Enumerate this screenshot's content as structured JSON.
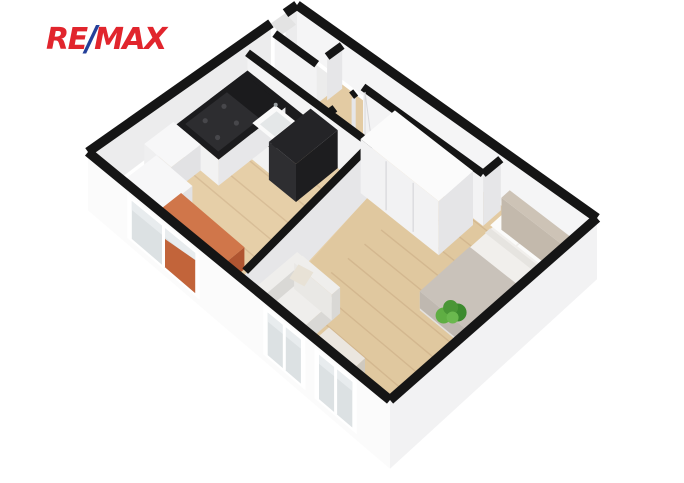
{
  "logo": {
    "re": "RE",
    "slash": "/",
    "max": "MAX",
    "red": "#E1252D",
    "blue": "#24409A"
  },
  "scene": {
    "background": "#ffffff",
    "description": "3D isometric cutaway floor plan of a one-bedroom apartment",
    "rooms": [
      "entry-vestibule",
      "bathroom",
      "hallway",
      "kitchen",
      "living-bedroom"
    ],
    "objects": [
      "kitchen-counter",
      "cooktop",
      "kitchen-sink",
      "tall-black-cabinet",
      "white-cabinet",
      "washing-machine",
      "orange-dining-table",
      "wardrobe",
      "double-bed",
      "pillows",
      "headboard",
      "sofa",
      "sofa-pillow",
      "coffee-table",
      "plant",
      "window",
      "window",
      "window",
      "entry-door-opening",
      "bathroom-door-opening",
      "bedroom-door"
    ],
    "palette": {
      "wall_top": "#151515",
      "wall_face_u": "#f3f3f4",
      "wall_face_v": "#e6e6e8",
      "ext_tl_face": "#ececed",
      "ext_tr_face": "#f5f5f6",
      "ext_out_bl": "#fbfbfb",
      "ext_out_br": "#f2f2f3",
      "inner_bl": "#dcdcdd",
      "inner_br": "#e9e9eb",
      "floor_white": "#ececec",
      "floor_hall": "#e3cba3",
      "floor_kitchen": "#e6cfa8",
      "floor_bedroom": "#e0c89f",
      "plank_line": "rgba(140,100,60,0.16)",
      "counter_top": "#1b1b1d",
      "counter_face": "#f2f2f2",
      "counter_side": "#e7e7e9",
      "cooktop": "#2d2d30",
      "burner": "#47474b",
      "sink": "#fafafa",
      "sink_inner": "#e4e7e8",
      "faucet": "#9aa0a3",
      "tower_top": "#242427",
      "tower_l": "#2e2e31",
      "tower_r": "#1d1d1f",
      "appliance_top": "#f7f7f8",
      "appliance_l": "#efeff0",
      "appliance_r": "#e2e2e4",
      "washer_door": "#d4d4d7",
      "washer_door_in": "#bcbcc0",
      "orange_top": "#d0764a",
      "orange_l": "#c2643a",
      "orange_r": "#b05531",
      "wardrobe_top": "#fbfbfb",
      "wardrobe_front": "#f2f2f3",
      "wardrobe_side": "#e5e5e7",
      "wardrobe_seam": "#dcdcdf",
      "headboard_top": "#cdc3b6",
      "headboard_l": "#c3b9ac",
      "headboard_r": "#b7ad a0",
      "mattress_top": "#f1efec",
      "mattress_l": "#e4e1dd",
      "mattress_r": "#d8d5d0",
      "blanket": "#c9c2ba",
      "blanket_drape": "#bfb8b0",
      "pillow": "#fbfbfa",
      "pillow_edge": "#e6e4e0",
      "sofa_top": "#efeeec",
      "sofa_l": "#e9e8e5",
      "sofa_r": "#d9d8d5",
      "sofa_pillow": "#e8e2d6",
      "ctable_top": "#ebe6df",
      "ctable_l": "#ded8ce",
      "ctable_r": "#cfc9bf",
      "plant_1": "#4a9636",
      "plant_2": "#5fae43",
      "plant_3": "#3c8a2e",
      "plant_4": "#6ab84e",
      "glass": "#dce1e3",
      "glass_hi": "#e8ecee",
      "frame": "#ffffff",
      "threshold_wood": "#d9b988",
      "threshold_gray": "#e3e3e3",
      "door_leaf": "#f1f1f2",
      "door_edge": "#d8d8da"
    }
  }
}
